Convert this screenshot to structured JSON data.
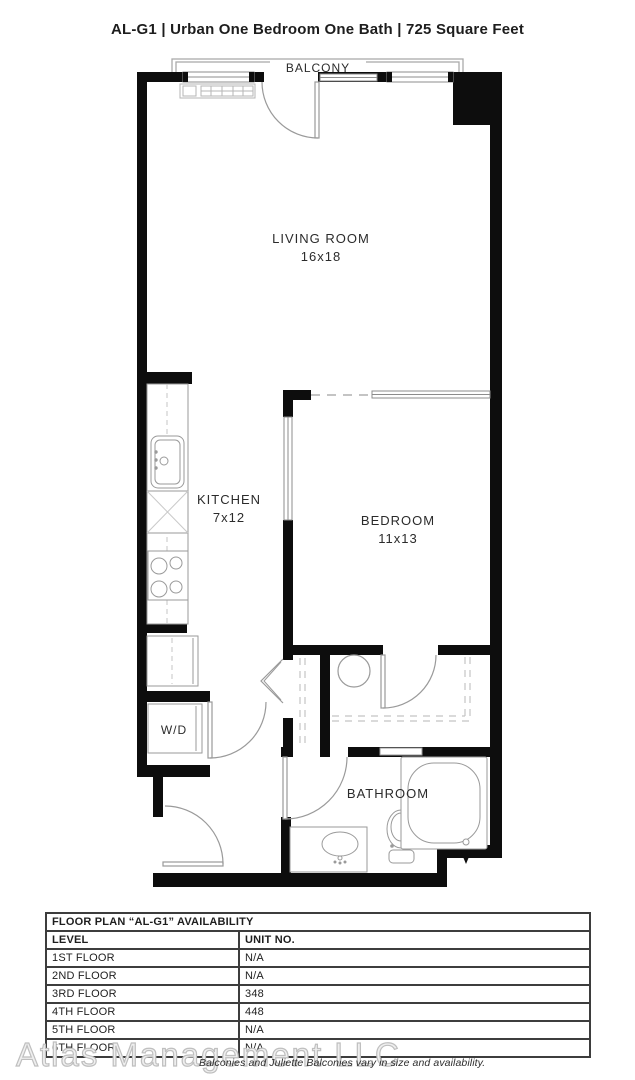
{
  "title": "AL-G1 | Urban One Bedroom One Bath | 725 Square Feet",
  "floor_plan": {
    "rooms": {
      "balcony": {
        "label": "BALCONY"
      },
      "living_room": {
        "label": "LIVING ROOM",
        "dimensions": "16x18"
      },
      "kitchen": {
        "label": "KITCHEN",
        "dimensions": "7x12"
      },
      "bedroom": {
        "label": "BEDROOM",
        "dimensions": "11x13"
      },
      "bathroom": {
        "label": "BATHROOM"
      },
      "washer_dryer": {
        "label": "W/D"
      }
    },
    "colors": {
      "wall": "#0d0d0d",
      "line": "#9a9a9a",
      "dash": "#c4c4c4"
    }
  },
  "availability_table": {
    "title": "FLOOR PLAN “AL-G1” AVAILABILITY",
    "columns": [
      "LEVEL",
      "UNIT NO."
    ],
    "rows": [
      {
        "level": "1ST FLOOR",
        "unit": "N/A"
      },
      {
        "level": "2ND FLOOR",
        "unit": "N/A"
      },
      {
        "level": "3RD FLOOR",
        "unit": "348"
      },
      {
        "level": "4TH FLOOR",
        "unit": "448"
      },
      {
        "level": "5TH FLOOR",
        "unit": "N/A"
      },
      {
        "level": "6TH FLOOR",
        "unit": "N/A"
      }
    ]
  },
  "footer": {
    "watermark": "Atlas Management LLC",
    "note": "Balconies and Juliette Balconies vary in size and availability."
  }
}
